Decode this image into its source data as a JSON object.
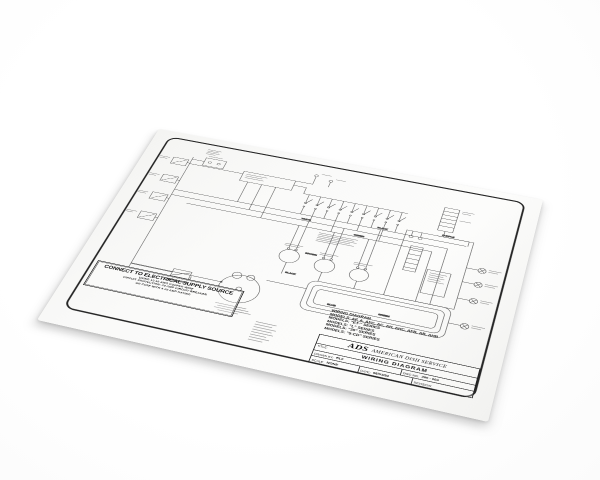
{
  "scene": {
    "background_color": "#ffffff",
    "paper_color": "#fafaf9",
    "ink_color": "#4a4a4a",
    "frame_color": "#262626"
  },
  "paper": {
    "supply_notice": {
      "heading": "CONNECT TO ELECTRICAL SUPPLY SOURCE",
      "line1": "USING 12-10 AWG COPPER WIRE",
      "line2": "CIRCUIT PROTECTION: 20 AMP CIRCUIT BREAKER",
      "line3": "OR FUSE WITH A 20 AMP RATING"
    },
    "timer_switch_label": "TIMER SWITCH",
    "wire_labels": {
      "black1": "BLACK",
      "black2": "BLACK",
      "white1": "WHITE",
      "green1": "GREEN",
      "green2": "GREEN",
      "purple1": "PURPLE",
      "brown1": "BROWN",
      "blue1": "BLUE"
    },
    "models_block": {
      "title": "WIRING DIAGRAM",
      "models": [
        "MODELS: AF, A, AFC, AC, AH, AHC, AFB, AB, AHB",
        "MODELS: \"ET-\" SERIES",
        "MODELS: \"L\" SERIES",
        "MODELS: \"30\" SERIES",
        "MODELS: \"5-CD\" SERIES"
      ]
    },
    "title_block": {
      "logo": "ADS",
      "company": "AMERICAN DISH SERVICE",
      "title_label": "TITLE:",
      "title_value": "WIRING DIAGRAM",
      "drawn_by_label": "DRAWN BY:",
      "drawn_by_value": "RLF",
      "dwg_label": "DWG NO:",
      "dwg_value": "260 - 004",
      "scale_label": "SCALE:",
      "scale_value": "NONE",
      "date_label": "DATE:",
      "date_value": "06/03/94",
      "revision_label": "REVISION:"
    }
  }
}
